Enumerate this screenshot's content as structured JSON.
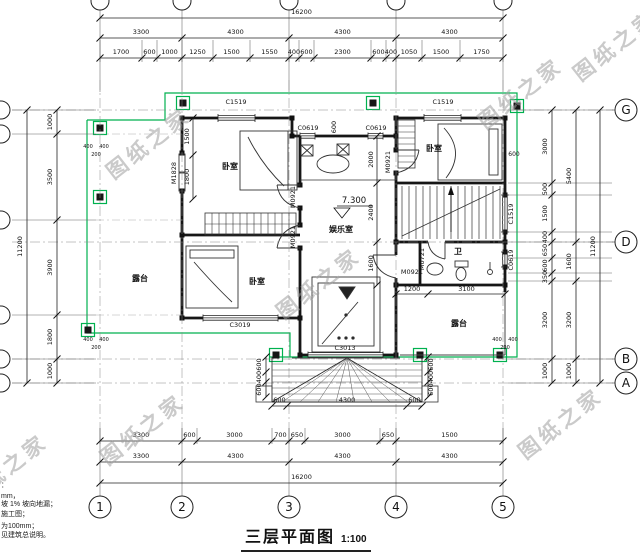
{
  "watermark": "图纸之家",
  "title": {
    "name": "三层平面图",
    "scale": "1:100"
  },
  "elevation": "7.300",
  "rooms": {
    "bedroom_tl": "卧室",
    "bedroom_tr": "卧室",
    "bedroom_bl": "卧室",
    "terrace_left": "露台",
    "terrace_br": "露台",
    "hall": "娱乐室",
    "bath": "卫"
  },
  "openings": {
    "c1519_a": "C1519",
    "c1519_b": "C1519",
    "c1519_side": "C1519",
    "c0619_a": "C0619",
    "c0619_b": "C0619",
    "c0619_side": "C0619",
    "c3019": "C3019",
    "c3013": "C3013",
    "m1828": "M1828",
    "m0921_a": "M0921",
    "m0921_b": "M0921",
    "m0921_c": "M0921",
    "m0921_d": "M0921",
    "m0721": "M0721"
  },
  "axes": {
    "bottom": [
      "1",
      "2",
      "3",
      "4",
      "5"
    ],
    "right": [
      "G",
      "D",
      "B",
      "A"
    ]
  },
  "dims": {
    "top_overall": "16200",
    "top_bays": [
      "3300",
      "4300",
      "4300",
      "4300"
    ],
    "top_detail": [
      "1700",
      "600",
      "1000",
      "1250",
      "1500",
      "1550",
      "400",
      "600",
      "2300",
      "600",
      "400",
      "1050",
      "1500",
      "1750"
    ],
    "bottom_detail": [
      "3300",
      "600",
      "3000",
      "700",
      "650",
      "3000",
      "650",
      "1500"
    ],
    "bottom_bays": [
      "3300",
      "4300",
      "4300",
      "4300"
    ],
    "bottom_overall": "16200",
    "left_overall": "11200",
    "left_detail": [
      "1000",
      "3500",
      "3900",
      "1800",
      "1000"
    ],
    "right_detail": [
      "3000",
      "500",
      "1500",
      "400",
      "650",
      "600",
      "350",
      "3200",
      "1000"
    ],
    "right_mid": [
      "5400",
      "1600",
      "3200",
      "1000"
    ],
    "right_overall": "11200",
    "porch": [
      "600",
      "4300",
      "600"
    ],
    "porch_side": [
      "600",
      "400",
      "600"
    ],
    "int_left": [
      "1500",
      "1800"
    ],
    "int_mid": [
      "2000",
      "2400",
      "1600"
    ],
    "int_terrace": [
      "1200",
      "3100"
    ],
    "col_group": [
      "400",
      "400",
      "200"
    ],
    "d600_top": "600",
    "d600_right": "600"
  },
  "notes": [
    "：",
    "mm，",
    "坡 1% 坡向地漏；",
    "施工图；",
    "为100mm；",
    "见建筑总说明。"
  ],
  "colors": {
    "highlight_green": "#00b14f",
    "wall": "#161616",
    "watermark_gray": "#a0a0a0"
  }
}
